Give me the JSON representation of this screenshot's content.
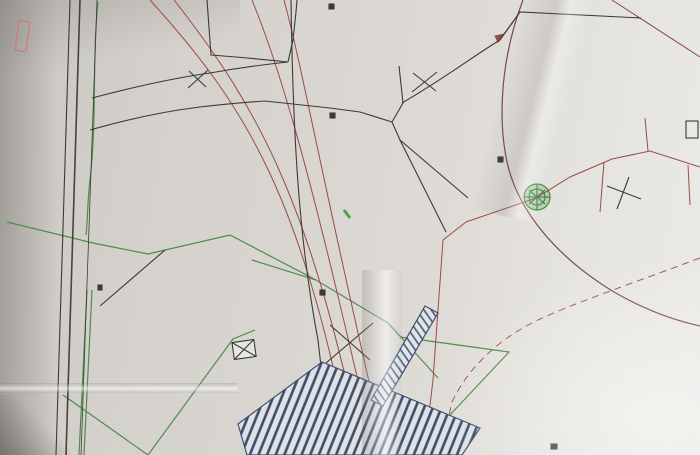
{
  "palette": {
    "black": "#3a3a36",
    "red": "#9c4a44",
    "red2": "#b05548",
    "orange": "#c0703f",
    "green": "#4e8c49",
    "blue": "#4a63ae",
    "blue2": "#4a5f94",
    "purple": "#7a4652",
    "pink": "#cf7a85"
  },
  "parcels": [
    {
      "n": "1",
      "cx": 261,
      "cy": 23,
      "ax": 277,
      "ay": 27,
      "t": "S=342 m²",
      "r": 97
    },
    {
      "n": "2",
      "cx": 156,
      "cy": 46,
      "ax": 136,
      "ay": 46,
      "t": "S=302 m²",
      "r": 97
    },
    {
      "n": "3",
      "cx": 289,
      "cy": 196,
      "ax": 269,
      "ay": 190,
      "t": "S=457 m²",
      "r": 97
    },
    {
      "n": "4",
      "cx": 161,
      "cy": 201,
      "ax": 144,
      "ay": 201,
      "t": "S=410 m²",
      "r": 97
    },
    {
      "n": "5",
      "cx": 196,
      "cy": 337,
      "ax": 181,
      "ay": 341,
      "t": "S=1206 m²",
      "r": 97
    },
    {
      "n": "7",
      "cx": 438,
      "cy": 119,
      "ax": 456,
      "ay": 114,
      "t": "S=503 m²",
      "r": 97
    },
    {
      "n": "8",
      "cx": 401,
      "cy": 217,
      "ax": 383,
      "ay": 215,
      "t": "S=481 m²",
      "r": 97
    }
  ],
  "labels": [
    {
      "t": "Sentier",
      "x": 64,
      "y": 172,
      "r": 97,
      "c": "black",
      "s": 15,
      "f": "serif",
      "b": 1
    },
    {
      "t": "(terre)",
      "x": 68,
      "y": 250,
      "r": 97,
      "c": "black",
      "s": 8,
      "f": "serif"
    },
    {
      "t": "Canal",
      "x": 57,
      "y": 402,
      "r": 97,
      "c": "black",
      "s": 15,
      "f": "serif",
      "b": 1
    },
    {
      "t": "IM.157",
      "x": 26,
      "y": 300,
      "r": 100,
      "c": "red2",
      "s": 12,
      "b": 1
    },
    {
      "t": "IM.162",
      "x": 546,
      "y": 74,
      "r": 100,
      "c": "blue",
      "s": 12,
      "b": 1
    },
    {
      "t": "23.58",
      "x": 555,
      "y": 100,
      "r": 100,
      "c": "black",
      "s": 8,
      "b": 1
    },
    {
      "t": "Section IM n° 162",
      "x": 590,
      "y": 96,
      "r": 160,
      "c": "orange",
      "s": 10
    },
    {
      "t": "Section IM n° 163",
      "x": 201,
      "y": 212,
      "r": 155,
      "c": "orange",
      "s": 10
    },
    {
      "t": "Section IM n° 160",
      "x": 479,
      "y": 319,
      "r": 162,
      "c": "red2",
      "s": 9.5
    },
    {
      "t": "(encadrement)",
      "x": 90,
      "y": 218,
      "r": 97,
      "c": "red",
      "s": 7.5
    },
    {
      "t": "Piquet fer existant",
      "x": 83,
      "y": 313,
      "r": 97,
      "c": "black",
      "s": 7
    },
    {
      "t": "décalé de 6cm",
      "x": 70,
      "y": 313,
      "r": 97,
      "c": "black",
      "s": 7
    },
    {
      "t": "Piquet fer",
      "x": 97,
      "y": 14,
      "r": 100,
      "c": "red",
      "s": 7
    },
    {
      "t": "Pente",
      "x": 67,
      "y": 20,
      "r": 97,
      "c": "black",
      "s": 6.5
    },
    {
      "t": "(altitude câble M.T.)",
      "x": 279,
      "y": 166,
      "r": 128,
      "c": "red",
      "s": 7.5
    },
    {
      "t": "Borne",
      "x": 338,
      "y": 303,
      "r": 97,
      "c": "black",
      "s": 7
    },
    {
      "t": "Bancoul",
      "x": 533,
      "y": 247,
      "r": 183,
      "c": "green",
      "s": 13
    },
    {
      "t": "Ravine",
      "x": 597,
      "y": 212,
      "r": 183,
      "c": "green",
      "s": 13
    },
    {
      "t": "ravine",
      "x": 662,
      "y": 7,
      "r": 97,
      "c": "green",
      "s": 9
    },
    {
      "t": "surplus de terrain",
      "x": 628,
      "y": 33,
      "r": 97,
      "c": "green",
      "s": 8
    },
    {
      "t": "hors lot",
      "x": 606,
      "y": 14,
      "r": 97,
      "c": "green",
      "s": 8
    },
    {
      "t": "Haut de la ravine",
      "x": 438,
      "y": 358,
      "r": 97,
      "c": "green",
      "s": 7.5
    },
    {
      "t": "Hors lot",
      "x": 413,
      "y": 438,
      "r": 115,
      "c": "green",
      "s": 8
    },
    {
      "t": "Rez escalier",
      "x": 421,
      "y": 356,
      "r": 97,
      "c": "blue2",
      "s": 7.5
    },
    {
      "t": "case",
      "x": 296,
      "y": 428,
      "r": 183,
      "c": "green",
      "s": 11
    },
    {
      "t": "mur",
      "x": 483,
      "y": 214,
      "r": 188,
      "c": "red",
      "s": 6.5
    },
    {
      "t": "haut",
      "x": 571,
      "y": 178,
      "r": 188,
      "c": "red",
      "s": 6.5
    },
    {
      "t": "S=729 m²",
      "x": 502,
      "y": 149,
      "r": 103,
      "c": "black",
      "s": 8
    },
    {
      "t": "S=213 m²",
      "x": 349,
      "y": 424,
      "r": 97,
      "c": "black",
      "s": 8
    }
  ],
  "measurements": [
    {
      "t": "3.42",
      "x": 153,
      "y": 87,
      "r": 190
    },
    {
      "t": "2.87",
      "x": 173,
      "y": 82,
      "r": 190
    },
    {
      "t": "9.47",
      "x": 201,
      "y": 75,
      "r": 192
    },
    {
      "t": "18.01",
      "x": 213,
      "y": 18,
      "r": 97
    },
    {
      "t": "3.06",
      "x": 90,
      "y": 96,
      "r": 188
    },
    {
      "t": "7.83",
      "x": 149,
      "y": 118,
      "r": 188
    },
    {
      "t": "8.97",
      "x": 177,
      "y": 113,
      "r": 188
    },
    {
      "t": "1.56",
      "x": 201,
      "y": 110,
      "r": 188
    },
    {
      "t": "7.38",
      "x": 223,
      "y": 108,
      "r": 188
    },
    {
      "t": "11.03",
      "x": 247,
      "y": 70,
      "r": 188
    },
    {
      "t": "2.87",
      "x": 274,
      "y": 68,
      "r": 188
    },
    {
      "t": "7.01",
      "x": 314,
      "y": 67,
      "r": 207
    },
    {
      "t": "2.80",
      "x": 297,
      "y": 38,
      "r": 97
    },
    {
      "t": "3.40",
      "x": 300,
      "y": 18,
      "r": 120
    },
    {
      "t": "7.73",
      "x": 325,
      "y": 60,
      "r": 215
    },
    {
      "t": "6.43",
      "x": 427,
      "y": 68,
      "r": 188
    },
    {
      "t": "8.18",
      "x": 404,
      "y": 87,
      "r": 97
    },
    {
      "t": "0.87",
      "x": 423,
      "y": 112,
      "r": 188
    },
    {
      "t": "10.34",
      "x": 381,
      "y": 118,
      "r": 188
    },
    {
      "t": "4.73",
      "x": 398,
      "y": 126,
      "r": 235
    },
    {
      "t": "12.86",
      "x": 252,
      "y": 112,
      "r": 188
    },
    {
      "t": "10.69",
      "x": 478,
      "y": 47,
      "r": 190
    },
    {
      "t": "4.38",
      "x": 512,
      "y": 31,
      "r": 170
    },
    {
      "t": "16.34",
      "x": 444,
      "y": 189,
      "r": 97
    },
    {
      "t": "13.83",
      "x": 271,
      "y": 258,
      "r": 115
    },
    {
      "t": "21.00",
      "x": 104,
      "y": 211,
      "r": 97
    },
    {
      "t": "21.55",
      "x": 207,
      "y": 170,
      "r": 97
    },
    {
      "t": "8.49",
      "x": 215,
      "y": 237,
      "r": 158
    },
    {
      "t": "5.75",
      "x": 189,
      "y": 253,
      "r": 158
    },
    {
      "t": "3.57",
      "x": 203,
      "y": 257,
      "r": 158
    },
    {
      "t": "10.59",
      "x": 101,
      "y": 313,
      "r": 97
    },
    {
      "t": "24.18",
      "x": 96,
      "y": 425,
      "r": 97
    },
    {
      "t": "13.28",
      "x": 253,
      "y": 410,
      "r": 97
    },
    {
      "t": "1.53",
      "x": 238,
      "y": 416,
      "r": 97
    },
    {
      "t": "11.75",
      "x": 375,
      "y": 304,
      "r": 188
    },
    {
      "t": "6.59",
      "x": 497,
      "y": 219,
      "r": 188
    },
    {
      "t": "13.75",
      "x": 444,
      "y": 261,
      "r": 188
    },
    {
      "t": "28.51",
      "x": 452,
      "y": 441,
      "r": 97
    },
    {
      "t": "1.68",
      "x": 507,
      "y": 359,
      "r": 210
    },
    {
      "t": "28.38",
      "x": 302,
      "y": 201,
      "r": 97
    },
    {
      "t": "4.09",
      "x": 304,
      "y": 224,
      "r": 97
    },
    {
      "t": "18.41",
      "x": 96,
      "y": 35,
      "r": 97
    },
    {
      "t": "1.35",
      "x": 305,
      "y": 285,
      "r": 97
    }
  ]
}
